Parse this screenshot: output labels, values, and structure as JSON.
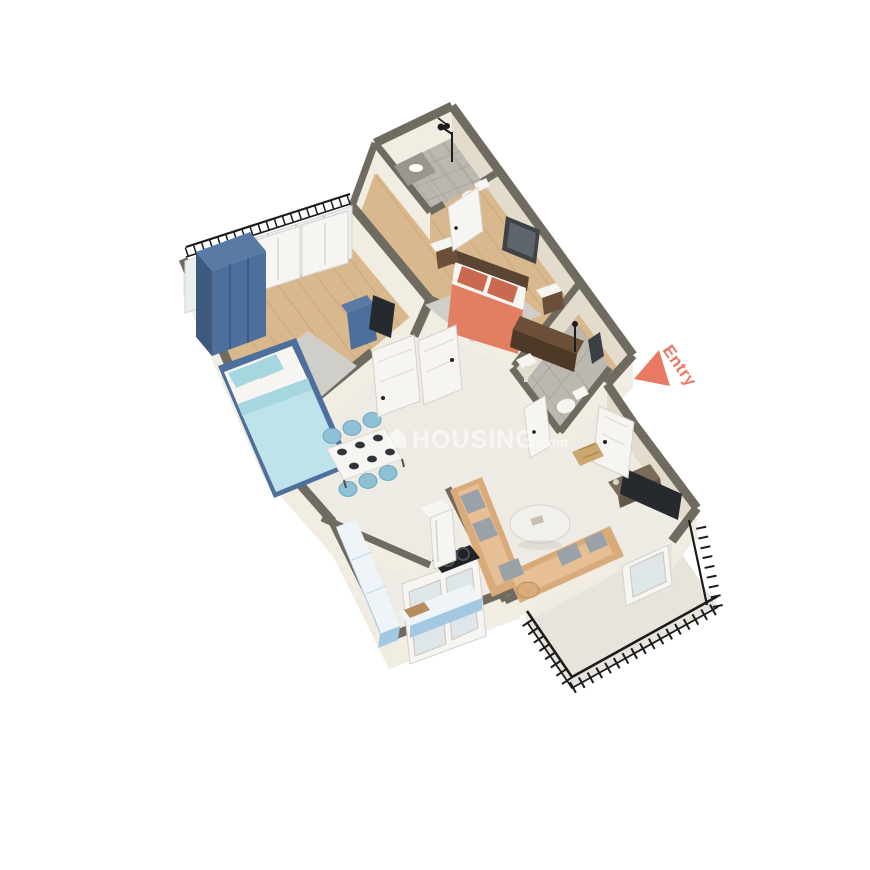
{
  "scene": {
    "width": 870,
    "height": 870,
    "background": "#ffffff"
  },
  "labels": {
    "entry": "Entry"
  },
  "watermark": {
    "brand": "HOUSING",
    "suffix": ".com"
  },
  "icons": {
    "entry_arrow": "triangle-pointing-left",
    "watermark_house": "house"
  },
  "palette": {
    "wallTop": "#6f6b60",
    "wallFace": "#f2ede3",
    "wallFaceShade": "#e3dbcc",
    "wood": "#d9b88e",
    "woodLine": "#c29a6b",
    "marble": "#eeebe4",
    "marbleBalcony": "#e8e4dc",
    "tile": "#bab8b1",
    "tileLine": "#a39f97",
    "rug": "#d0cec9",
    "white": "#f7f5f1",
    "glass": "#e9eff1",
    "blueDark": "#3d5a7e",
    "blueMid": "#4c6f9b",
    "blueTopCol": "#5a7aa6",
    "blueLight": "#bfe3ea",
    "blueSheet": "#a6d6e0",
    "coral": "#e27f62",
    "coralDark": "#c96a50",
    "headboard": "#5a4433",
    "chairBlue": "#8ec0d6",
    "counterBlue": "#a3c8e2",
    "tan": "#d9ab7a",
    "tanLight": "#e6c094",
    "pillowGray": "#9aa1a8",
    "dark": "#26292e",
    "woodDark": "#6b4f38",
    "woodDarker": "#4e3826",
    "railing": "#1c1c1c",
    "accent": "#e87a64"
  }
}
